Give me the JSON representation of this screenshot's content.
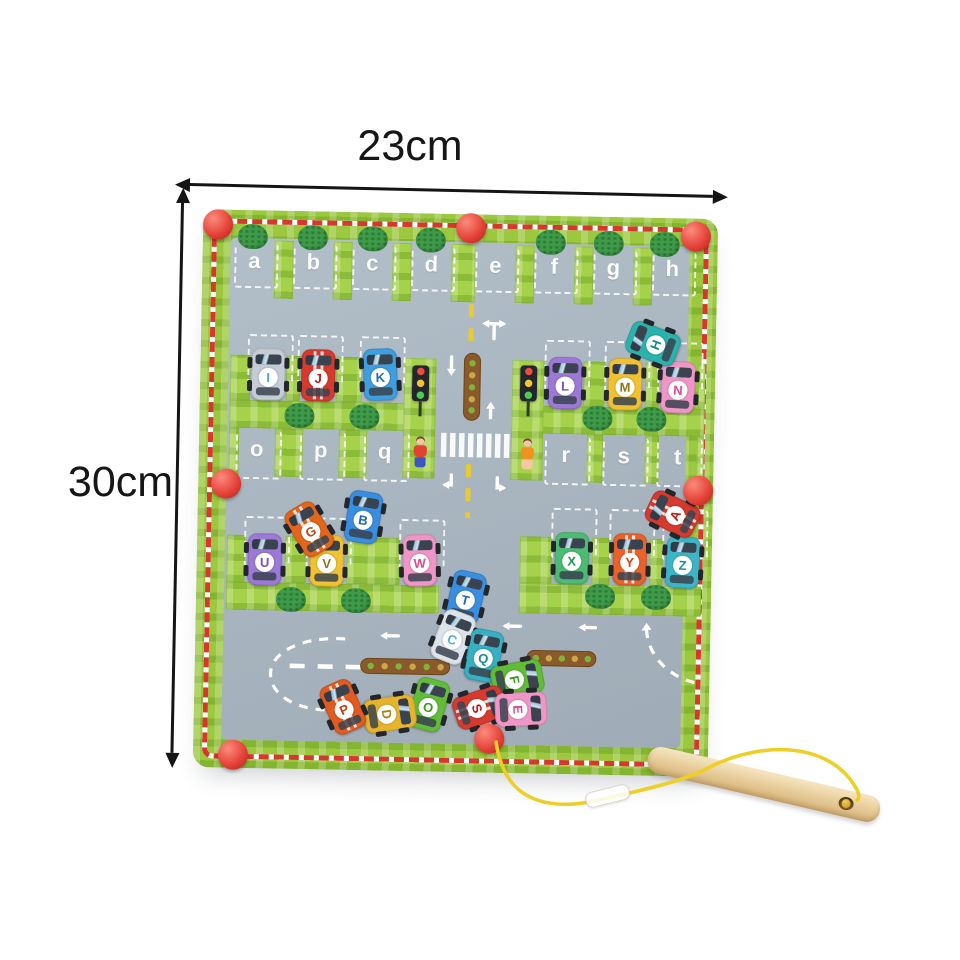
{
  "annotations": {
    "width_label": "23cm",
    "height_label": "30cm"
  },
  "board": {
    "colors": {
      "border_green": "#9bc83e",
      "wall_green": "#a6d24b",
      "field_gray": "#a7b3bf",
      "stripe_red": "#d6382c",
      "knob_red": "#e6443a",
      "tree_green": "#3f9a49",
      "track_brown": "#8a5a2a",
      "marking_white": "#ffffff",
      "dash_yellow": "#e9ca33"
    },
    "slots": {
      "top": [
        "a",
        "b",
        "c",
        "d",
        "e",
        "f",
        "g",
        "h"
      ],
      "middle_left": [
        "o",
        "p",
        "q"
      ],
      "middle_right": [
        "r",
        "s",
        "t"
      ]
    },
    "parked_cars": [
      {
        "letter": "I",
        "body": "#c6ccd6",
        "ink": "#4aa4d8",
        "x": 68,
        "y": 164,
        "rot": 0
      },
      {
        "letter": "J",
        "body": "#d63a2e",
        "ink": "#c01818",
        "x": 118,
        "y": 164,
        "rot": 0,
        "stripes": true
      },
      {
        "letter": "K",
        "body": "#3f9ede",
        "ink": "#1d6fb8",
        "x": 180,
        "y": 162,
        "rot": -3
      },
      {
        "letter": "L",
        "body": "#9d79d6",
        "ink": "#7b4fc0",
        "x": 365,
        "y": 167,
        "rot": 0
      },
      {
        "letter": "M",
        "body": "#f0c232",
        "ink": "#8a7a14",
        "x": 425,
        "y": 167,
        "rot": 0
      },
      {
        "letter": "N",
        "body": "#f096c6",
        "ink": "#e0488c",
        "x": 478,
        "y": 169,
        "rot": 2
      },
      {
        "letter": "U",
        "body": "#9d79d6",
        "ink": "#7b4fc0",
        "x": 68,
        "y": 349,
        "rot": 0
      },
      {
        "letter": "V",
        "body": "#f0c232",
        "ink": "#8a7a14",
        "x": 130,
        "y": 349,
        "rot": 0
      },
      {
        "letter": "W",
        "body": "#f096c6",
        "ink": "#e0488c",
        "x": 223,
        "y": 347,
        "rot": -2
      },
      {
        "letter": "X",
        "body": "#4cbc74",
        "ink": "#1e9a50",
        "x": 375,
        "y": 342,
        "rot": 0
      },
      {
        "letter": "Y",
        "body": "#e8622a",
        "ink": "#d4401a",
        "x": 433,
        "y": 342,
        "rot": 0,
        "stripes": true
      },
      {
        "letter": "Z",
        "body": "#3cb6c6",
        "ink": "#1a8fa4",
        "x": 486,
        "y": 344,
        "rot": 2
      }
    ],
    "loose_cars": [
      {
        "letter": "H",
        "body": "#2cb2ac",
        "ink": "#128a86",
        "x": 452,
        "y": 126,
        "rot": -70
      },
      {
        "letter": "A",
        "body": "#d63a2e",
        "ink": "#c01818",
        "x": 475,
        "y": 296,
        "rot": -65,
        "stripes": true
      },
      {
        "letter": "G",
        "body": "#e2661c",
        "ink": "#c04c0c",
        "x": 112,
        "y": 318,
        "rot": -32,
        "stripes": true
      },
      {
        "letter": "B",
        "body": "#3a8ee0",
        "ink": "#1a66c0",
        "x": 166,
        "y": 305,
        "rot": 8
      },
      {
        "letter": "T",
        "body": "#3a8ee0",
        "ink": "#1a66c0",
        "x": 270,
        "y": 383,
        "rot": 12
      },
      {
        "letter": "C",
        "body": "#dde3ea",
        "ink": "#55aede",
        "x": 258,
        "y": 423,
        "rot": 20
      },
      {
        "letter": "Q",
        "body": "#36b0c2",
        "ink": "#148aa0",
        "x": 289,
        "y": 441,
        "rot": 10
      },
      {
        "letter": "F",
        "body": "#62bc38",
        "ink": "#3a9a1e",
        "x": 323,
        "y": 464,
        "rot": 78
      },
      {
        "letter": "S",
        "body": "#d63a2e",
        "ink": "#c01818",
        "x": 286,
        "y": 493,
        "rot": 70,
        "stripes": true
      },
      {
        "letter": "E",
        "body": "#f096c6",
        "ink": "#e0488c",
        "x": 327,
        "y": 494,
        "rot": 86
      },
      {
        "letter": "O",
        "body": "#62bc38",
        "ink": "#3a9a1e",
        "x": 235,
        "y": 491,
        "rot": 14
      },
      {
        "letter": "D",
        "body": "#e6b42c",
        "ink": "#a88210",
        "x": 196,
        "y": 501,
        "rot": 80
      },
      {
        "letter": "P",
        "body": "#e25a20",
        "ink": "#c23c0e",
        "x": 149,
        "y": 495,
        "rot": -25,
        "stripes": true
      }
    ],
    "knobs": [
      [
        15,
        15
      ],
      [
        268,
        14
      ],
      [
        493,
        18
      ],
      [
        28,
        274
      ],
      [
        500,
        272
      ],
      [
        40,
        545
      ],
      [
        296,
        524
      ]
    ],
    "trees": [
      [
        50,
        26
      ],
      [
        110,
        26
      ],
      [
        170,
        26
      ],
      [
        228,
        26
      ],
      [
        348,
        26
      ],
      [
        406,
        26
      ],
      [
        462,
        26
      ],
      [
        100,
        204
      ],
      [
        165,
        204
      ],
      [
        398,
        201
      ],
      [
        452,
        201
      ],
      [
        95,
        388
      ],
      [
        160,
        388
      ],
      [
        404,
        379
      ],
      [
        460,
        379
      ]
    ],
    "traffic_lights": [
      [
        220,
        152
      ],
      [
        328,
        150
      ]
    ],
    "kids": [
      {
        "x": 221,
        "y": 223,
        "shirt": "#e04430",
        "legs": "#3c55c0"
      },
      {
        "x": 328,
        "y": 223,
        "shirt": "#f0921e",
        "legs": "#f6c7a0"
      }
    ]
  },
  "pen": {
    "wood": "#e9cf9d",
    "string": "#eecf25",
    "sleeve": "#ffffff"
  }
}
